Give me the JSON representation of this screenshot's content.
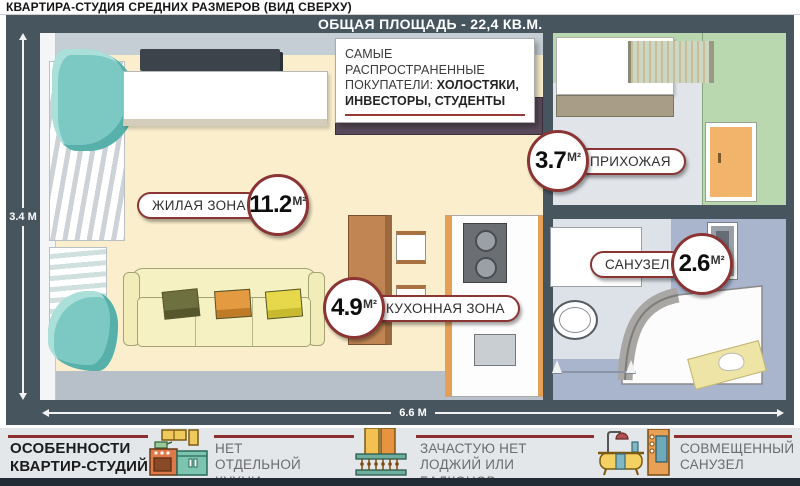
{
  "title": "КВАРТИРА-СТУДИЯ СРЕДНИХ РАЗМЕРОВ (ВИД СВЕРХУ)",
  "plan": {
    "header": "ОБЩАЯ ПЛОЩАДЬ - 22,4 КВ.М.",
    "buyers": {
      "normal": "САМЫЕ РАСПРОСТРАНЕННЫЕ ПОКУПАТЕЛИ: ",
      "bold": "ХОЛОСТЯКИ, ИНВЕСТОРЫ, СТУДЕНТЫ"
    },
    "dimensions": {
      "height": "3.4 М",
      "width": "6.6 М"
    },
    "areas": {
      "living": {
        "name": "ЖИЛАЯ ЗОНА",
        "value": "11.2",
        "unit": "М²"
      },
      "kitchen": {
        "name": "КУХОННАЯ ЗОНА",
        "value": "4.9",
        "unit": "М²"
      },
      "hallway": {
        "name": "ПРИХОЖАЯ",
        "value": "3.7",
        "unit": "М²"
      },
      "bathroom": {
        "name": "САНУЗЕЛ",
        "value": "2.6",
        "unit": "М²"
      }
    }
  },
  "features": {
    "title_line1": "ОСОБЕННОСТИ",
    "title_line2": "КВАРТИР-СТУДИЙ:",
    "items": [
      {
        "icon": "kitchen-icon",
        "text": "НЕТ ОТДЕЛЬНОЙ КУХНИ"
      },
      {
        "icon": "balcony-icon",
        "text": "ЗАЧАСТУЮ НЕТ ЛОДЖИЙ ИЛИ БАЛКОНОВ"
      },
      {
        "icon": "bathtub-icon",
        "text": "СОВМЕЩЕННЫЙ САНУЗЕЛ"
      }
    ]
  },
  "colors": {
    "frame": "#47555f",
    "accent_red": "#8b3434",
    "floor_cream": "#faeecd",
    "wall_green": "#bad8af",
    "bath_floor": "#a8b5cc"
  }
}
